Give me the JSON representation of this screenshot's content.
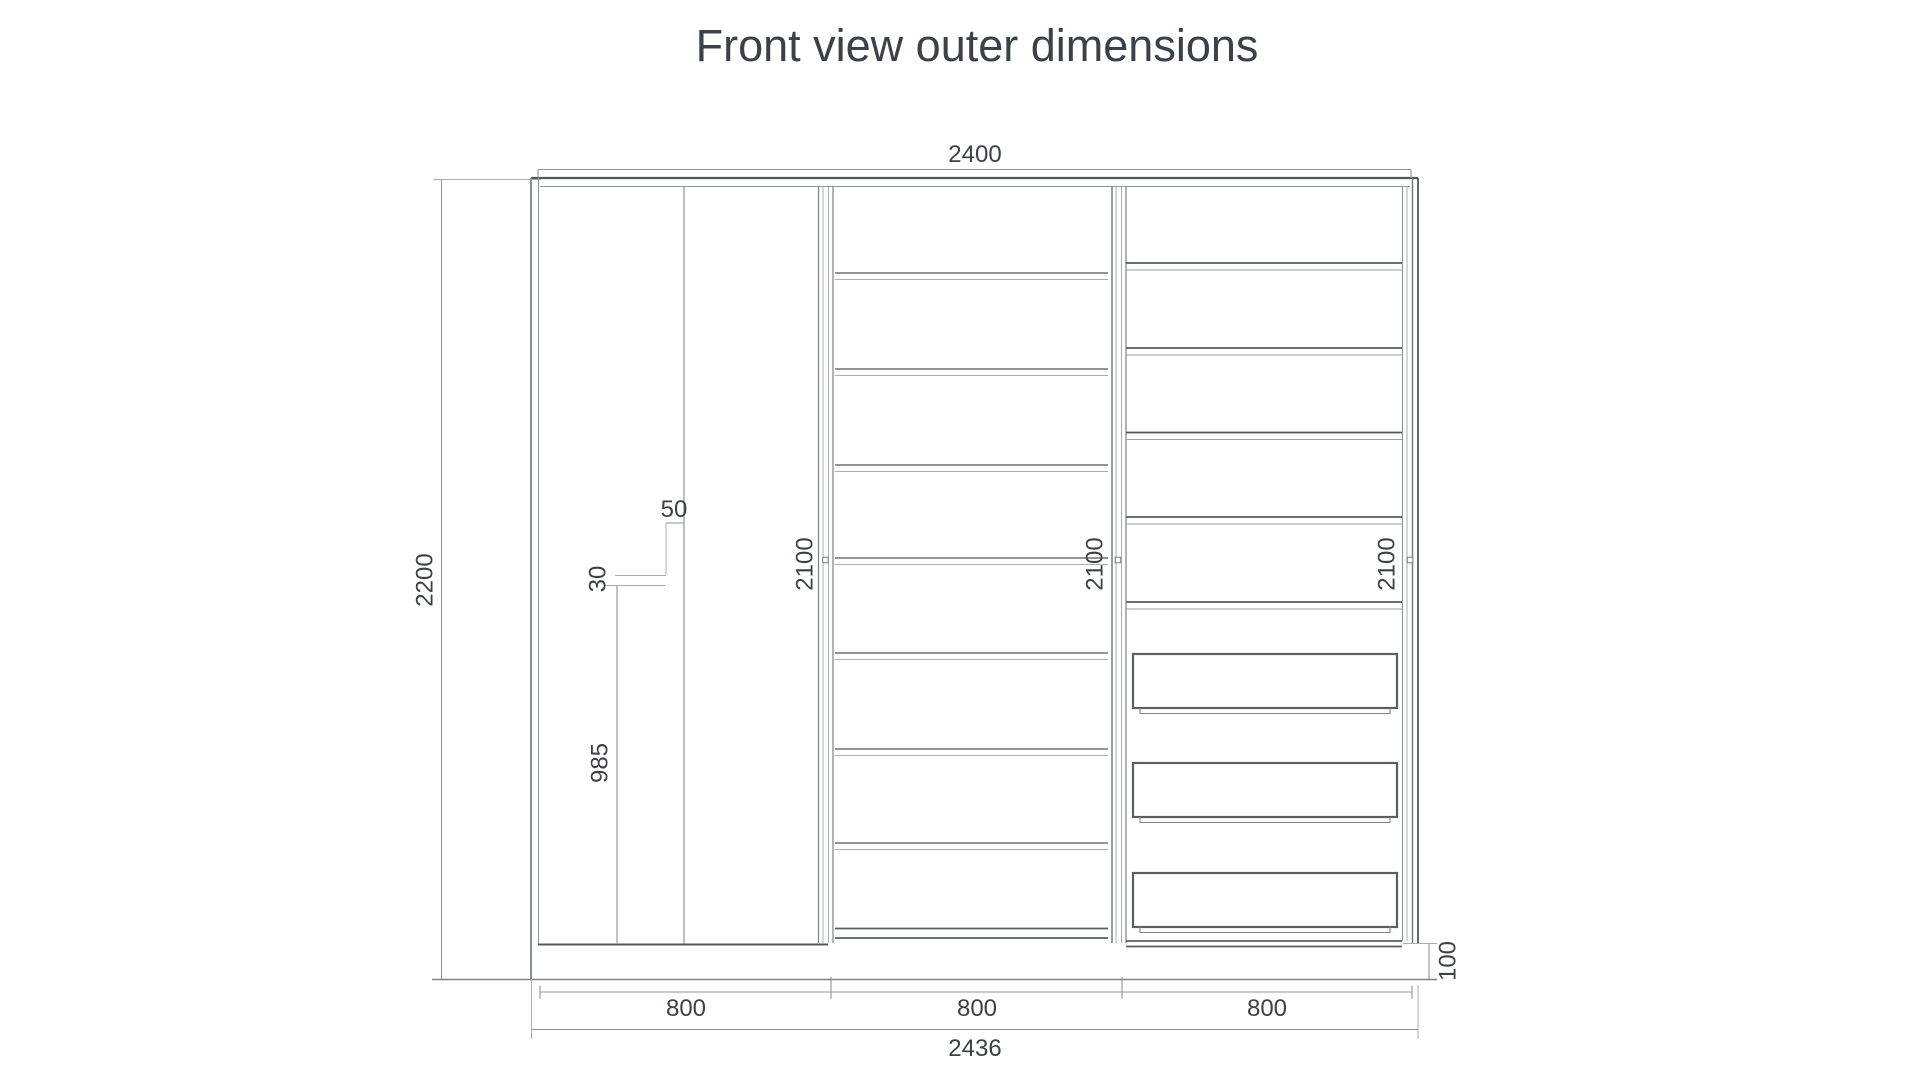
{
  "title": {
    "text": "Front view outer dimensions",
    "color": "#3b4148"
  },
  "drawing": {
    "background": "#ffffff",
    "line_color_dark": "#54585d",
    "line_color_mid": "#7d8287",
    "line_color_light": "#a9adb0",
    "dim_line_color": "#8f9497",
    "label_color": "#3d4146",
    "dimensions": {
      "overall_width": "2400",
      "overall_height": "2200",
      "outer_width_total": "2436",
      "module_widths": [
        "800",
        "800",
        "800"
      ],
      "module_inner_heights": [
        "2100",
        "2100",
        "2100"
      ],
      "plinth_height": "100",
      "rail_inset": "50",
      "rail_thickness": "30",
      "rail_height": "985"
    }
  }
}
